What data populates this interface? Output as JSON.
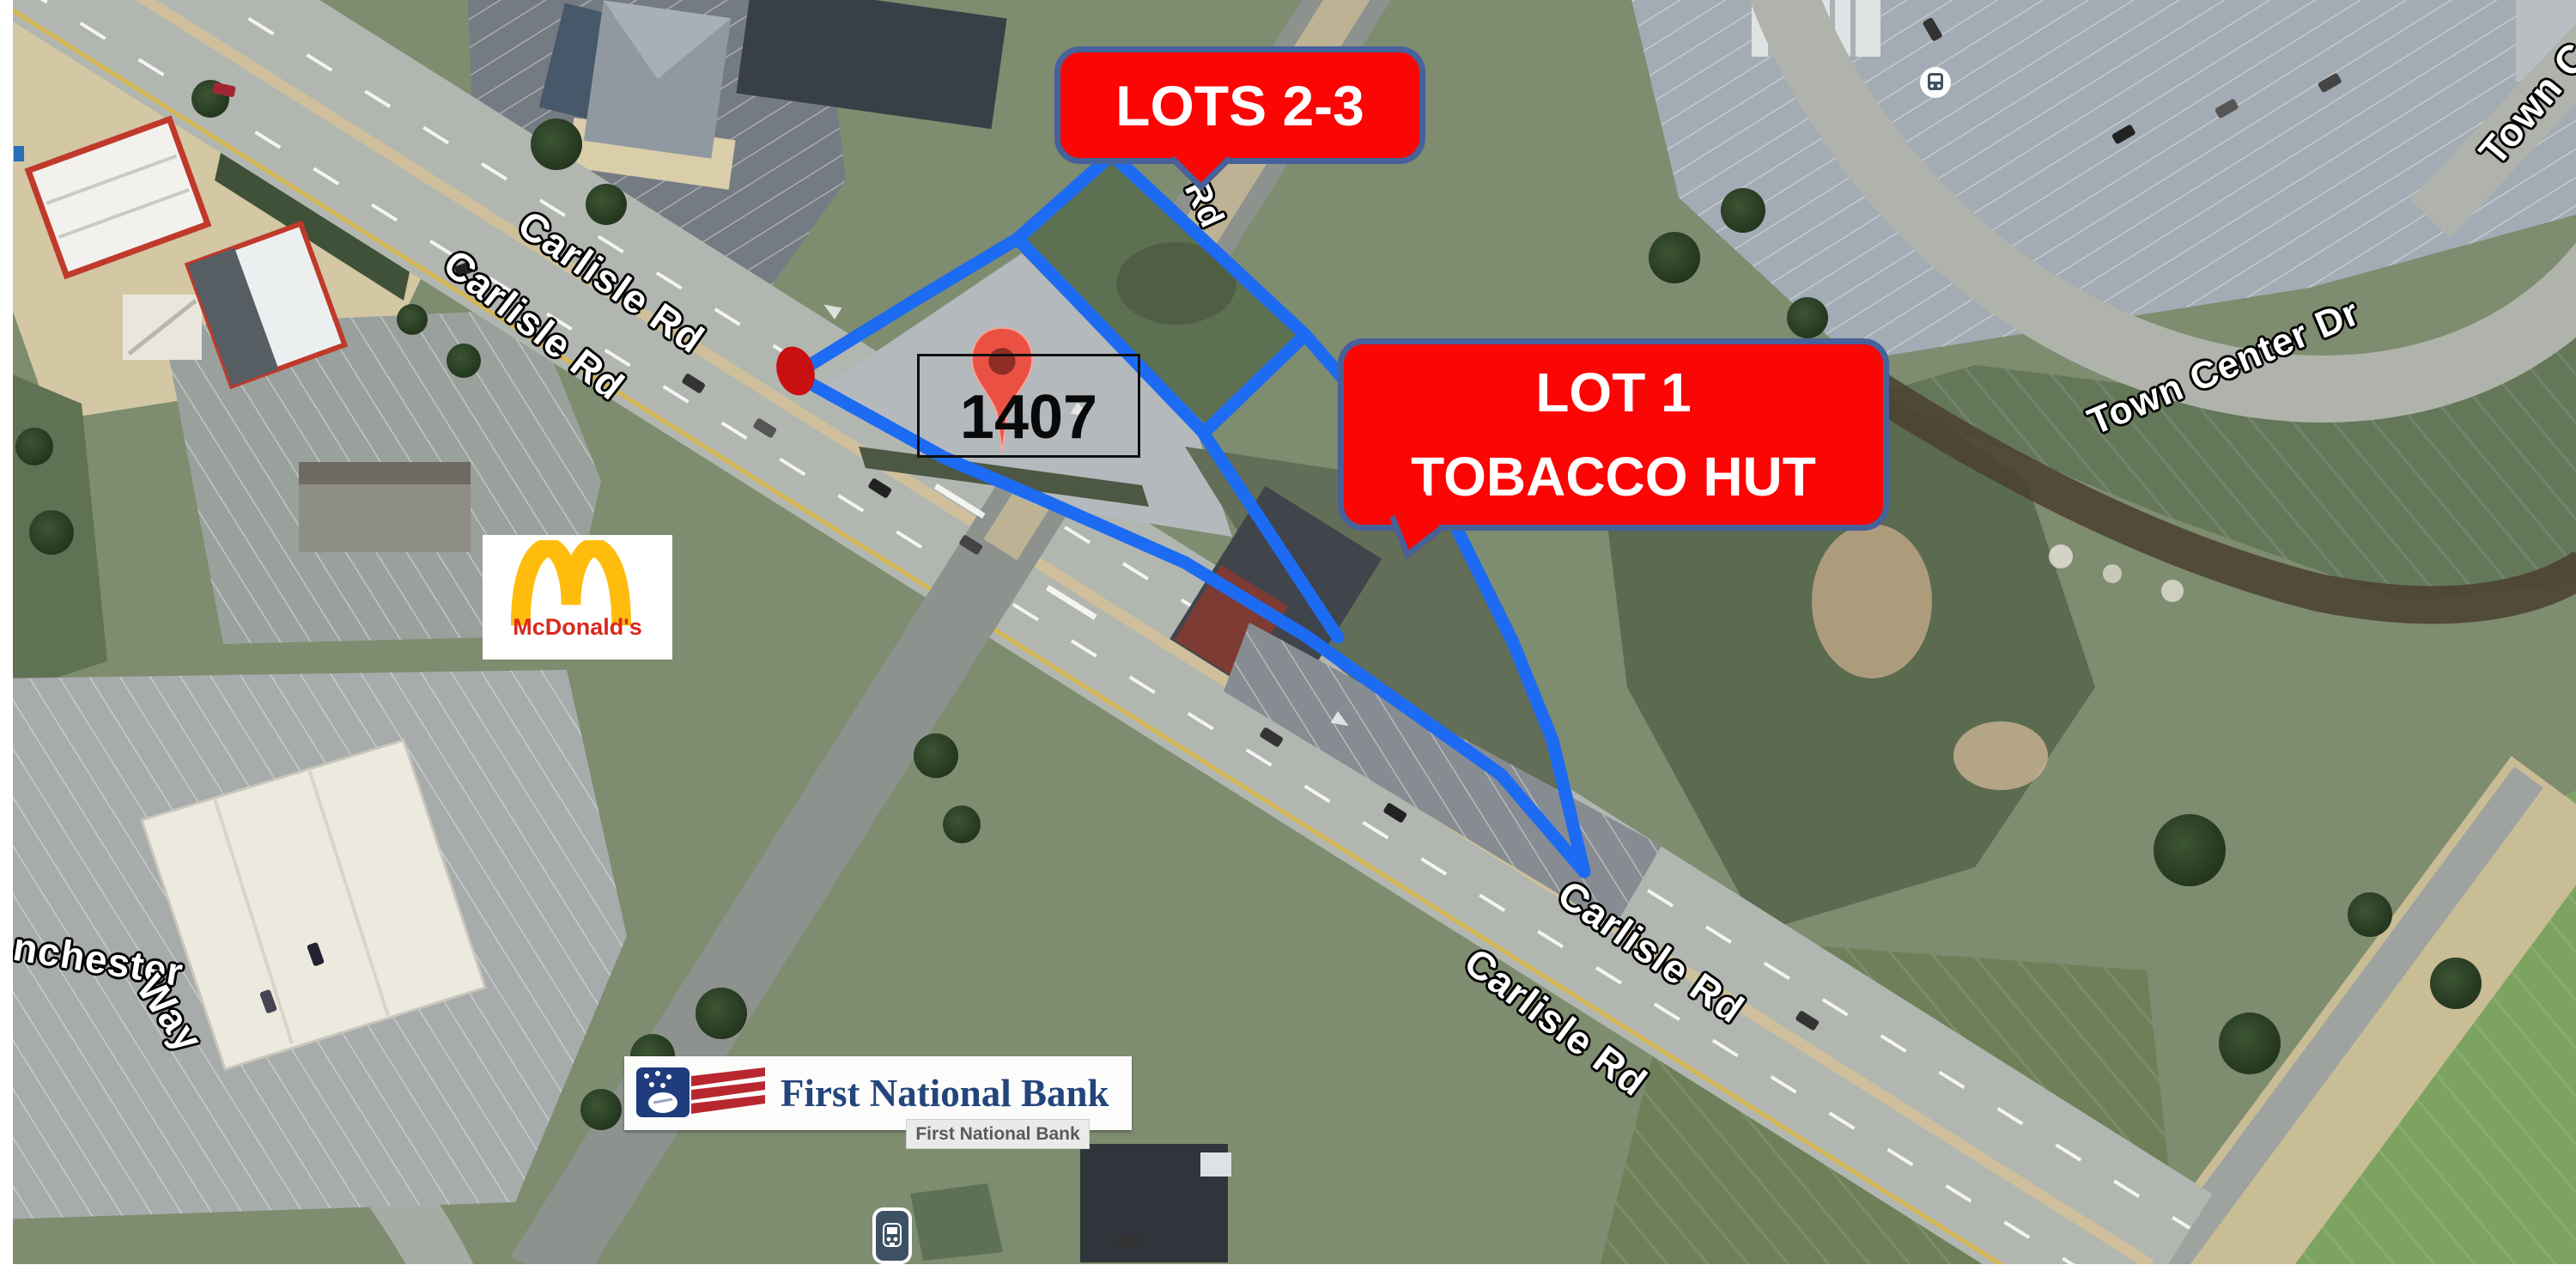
{
  "parcel": {
    "address": "1407"
  },
  "callouts": {
    "lots23": {
      "label": "LOTS 2-3"
    },
    "lot1": {
      "line1": "LOT 1",
      "line2": "TOBACCO HUT"
    }
  },
  "road_labels": [
    {
      "id": "carlisle-nw-upper",
      "text": "Carlisle Rd"
    },
    {
      "id": "carlisle-nw-lower",
      "text": "Carlisle Rd"
    },
    {
      "id": "carlisle-se-upper",
      "text": "Carlisle Rd"
    },
    {
      "id": "carlisle-se-lower",
      "text": "Carlisle Rd"
    },
    {
      "id": "town-center-dr",
      "text": "Town Center Dr"
    },
    {
      "id": "town-center-dr-corner",
      "text": "Town Center Dr"
    },
    {
      "id": "manchester-way-1",
      "text": "Manchester"
    },
    {
      "id": "manchester-way-2",
      "text": "Way"
    },
    {
      "id": "small-road",
      "text": "Rd"
    }
  ],
  "logos": {
    "mcdonalds": {
      "wordmark": "McDonald's"
    },
    "first_national_bank": {
      "wordmark": "First National Bank",
      "map_label": "First National Bank"
    }
  },
  "colors": {
    "boundary_blue": "#1d6bf3",
    "callout_red": "#fb0505",
    "callout_border": "#47619b",
    "pin_red": "#ea5143",
    "entrance_dot_red": "#c90f0f",
    "arches_gold": "#ffbc0d",
    "mcdonalds_red": "#da291c",
    "fnb_navy": "#24457c"
  }
}
